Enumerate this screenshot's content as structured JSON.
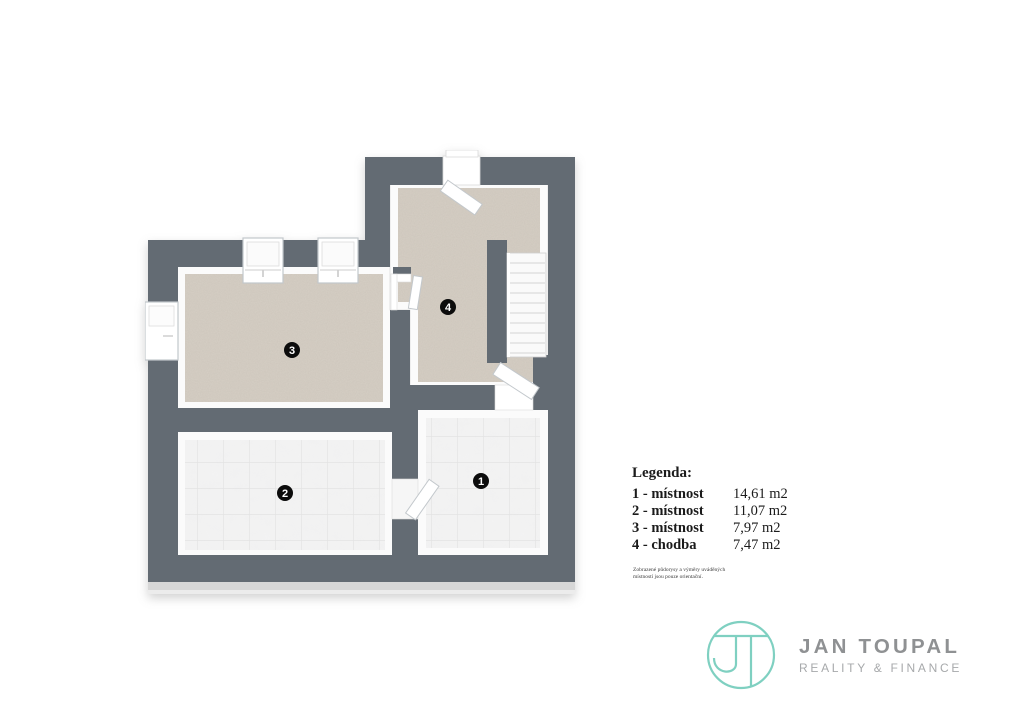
{
  "page": {
    "background": "#ffffff"
  },
  "plan": {
    "wall_color": "#636b73",
    "carpet_color": "#d6cfc5",
    "tile_color": "#f3f3f3",
    "badge_color": "#0c0c0c",
    "rooms": [
      {
        "number": "1",
        "name": "místnost"
      },
      {
        "number": "2",
        "name": "místnost"
      },
      {
        "number": "3",
        "name": "místnost"
      },
      {
        "number": "4",
        "name": "chodba"
      }
    ]
  },
  "legend": {
    "title": "Legenda:",
    "items": [
      {
        "label": "1 - místnost",
        "area": "14,61 m2"
      },
      {
        "label": "2 - místnost",
        "area": "11,07 m2"
      },
      {
        "label": "3 - místnost",
        "area": "7,97 m2"
      },
      {
        "label": "4 - chodba",
        "area": "7,47 m2"
      }
    ],
    "disclaimer": [
      "Zobrazené půdorysy a výměry uváděných",
      "místností jsou pouze orientační."
    ]
  },
  "branding": {
    "name": "JAN TOUPAL",
    "tagline": "REALITY & FINANCE",
    "monogram": "JT",
    "accent_color": "#7fd0c1",
    "text_color": "#8f9193"
  }
}
